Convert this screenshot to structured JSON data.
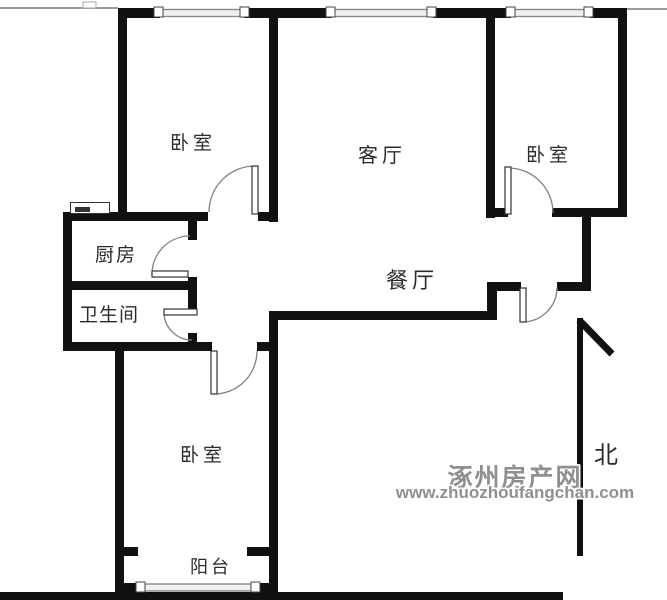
{
  "plan": {
    "type": "residential-floorplan",
    "rooms": [
      {
        "id": "bedroom-top-left",
        "label": "卧室"
      },
      {
        "id": "living-room",
        "label": "客厅"
      },
      {
        "id": "bedroom-top-right",
        "label": "卧室"
      },
      {
        "id": "kitchen",
        "label": "厨房"
      },
      {
        "id": "bathroom",
        "label": "卫生间"
      },
      {
        "id": "dining-room",
        "label": "餐厅"
      },
      {
        "id": "bedroom-bottom",
        "label": "卧室"
      },
      {
        "id": "balcony",
        "label": "阳台"
      }
    ],
    "compass": {
      "north_label": "北"
    },
    "watermark": {
      "site_name": "涿州房产网",
      "site_url": "www.zhuozhoufangchan.com"
    },
    "colors": {
      "wall": "#111111",
      "background": "#ffffff",
      "door_arc": "#808080",
      "window_fill": "#f0f0f0",
      "window_stroke": "#8a8a8a",
      "label": "#2b2b2b",
      "watermark": "#8f8f8f"
    }
  }
}
